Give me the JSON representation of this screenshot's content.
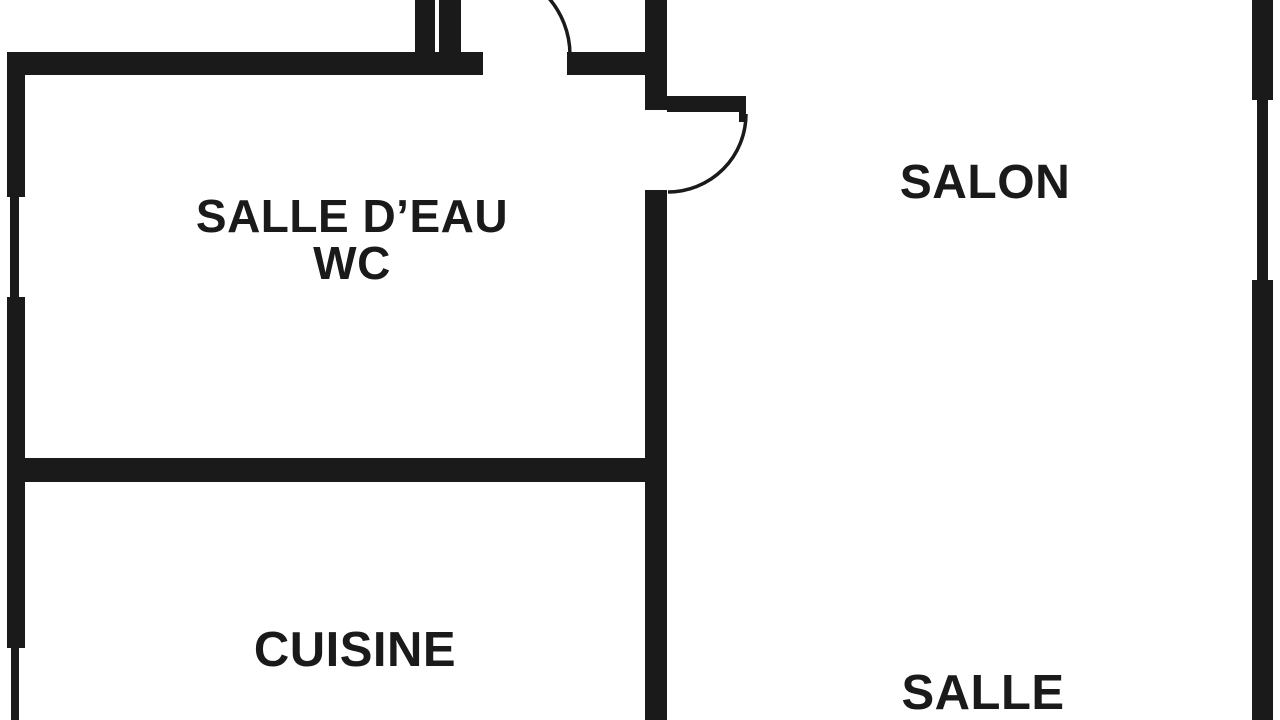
{
  "plan": {
    "type": "floor-plan",
    "rooms": {
      "salle_deau": {
        "line1": "SALLE D’EAU",
        "line2": "WC"
      },
      "salon": {
        "label": "SALON"
      },
      "cuisine": {
        "label": "CUISINE"
      },
      "salle": {
        "label": "SALLE"
      }
    },
    "colors": {
      "wall": "#1a1a1a",
      "background": "#ffffff",
      "text": "#1a1a1a"
    }
  }
}
